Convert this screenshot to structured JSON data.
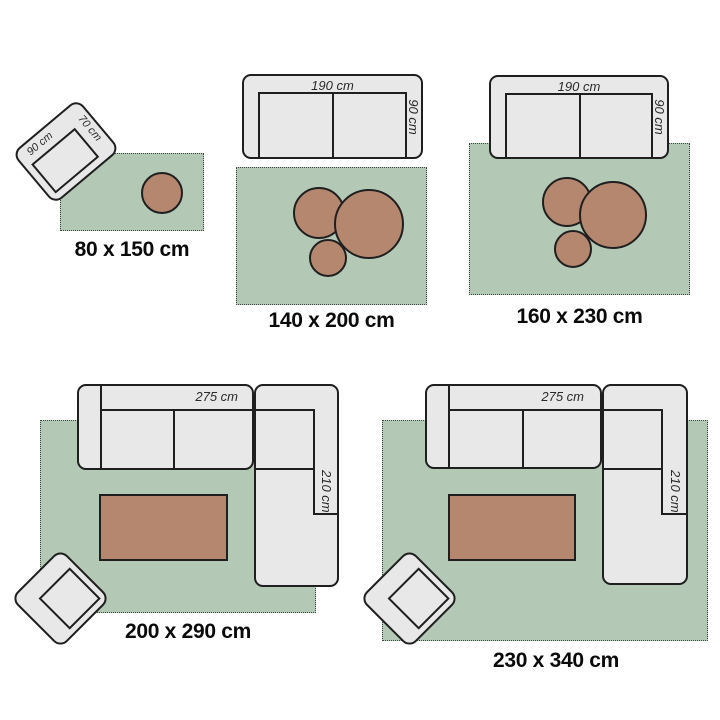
{
  "colors": {
    "rug": "#b3c9b5",
    "furniture": "#e8e8e8",
    "table": "#b5876f",
    "outline": "#1f1f1f",
    "label": "#0a0a0a",
    "dimension_text": "#2a2a2a",
    "background": "#ffffff"
  },
  "groups": [
    {
      "name": "80x150",
      "size_label": "80 x 150 cm",
      "dims": {
        "chair_width": "90 cm",
        "chair_depth": "70 cm"
      }
    },
    {
      "name": "140x200",
      "size_label": "140 x 200 cm",
      "dims": {
        "sofa_width": "190 cm",
        "sofa_depth": "90 cm"
      }
    },
    {
      "name": "160x230",
      "size_label": "160 x 230 cm",
      "dims": {
        "sofa_width": "190 cm",
        "sofa_depth": "90 cm"
      }
    },
    {
      "name": "200x290",
      "size_label": "200 x 290 cm",
      "dims": {
        "sofa_width": "275 cm",
        "sofa_depth": "210 cm"
      }
    },
    {
      "name": "230x340",
      "size_label": "230 x 340 cm",
      "dims": {
        "sofa_width": "275 cm",
        "sofa_depth": "210 cm"
      }
    }
  ]
}
